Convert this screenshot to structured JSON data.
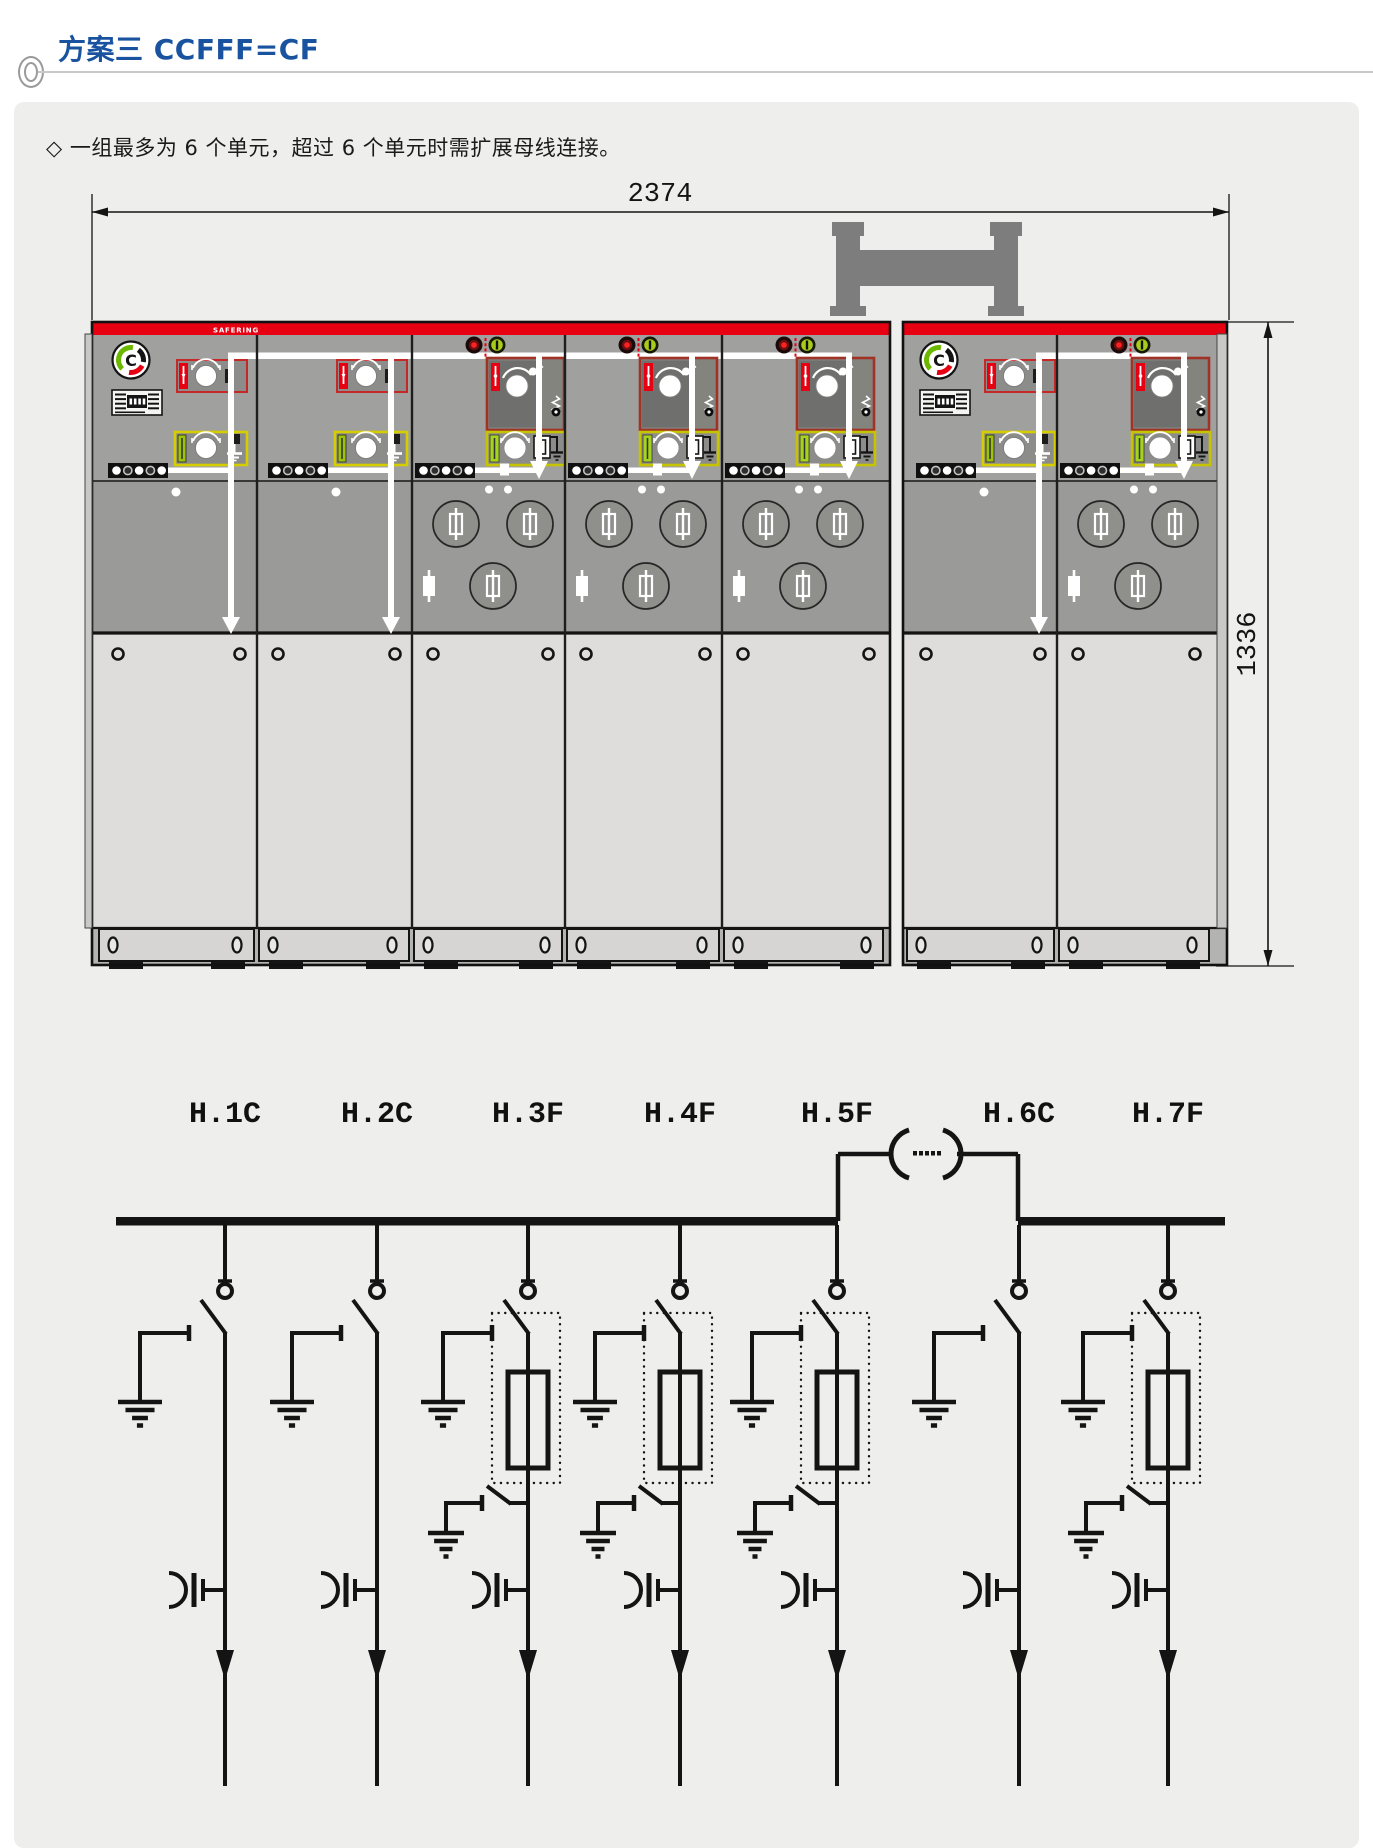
{
  "page": {
    "title": "方案三 CCFFF=CF",
    "note": "◇ 一组最多为 6 个单元，超过 6 个单元时需扩展母线连接。"
  },
  "front_view": {
    "brand": "SAFERING",
    "width_mm": "2374",
    "height_mm": "1336",
    "group1_unit_count": 5,
    "group2_unit_count": 2
  },
  "diagram": {
    "units": [
      {
        "label": "H.1C",
        "type": "C"
      },
      {
        "label": "H.2C",
        "type": "C"
      },
      {
        "label": "H.3F",
        "type": "F"
      },
      {
        "label": "H.4F",
        "type": "F"
      },
      {
        "label": "H.5F",
        "type": "F"
      },
      {
        "label": "H.6C",
        "type": "C"
      },
      {
        "label": "H.7F",
        "type": "F"
      }
    ]
  },
  "colors": {
    "accent_blue": "#19539f",
    "safering_red": "#e60012",
    "panel_yellow": "#d6cd00",
    "indicator_green": "#a8cc1c",
    "indicator_red": "#ff2020",
    "panel_bg": "#eeeeec",
    "cabinet_gray": "#9d9d9b"
  }
}
